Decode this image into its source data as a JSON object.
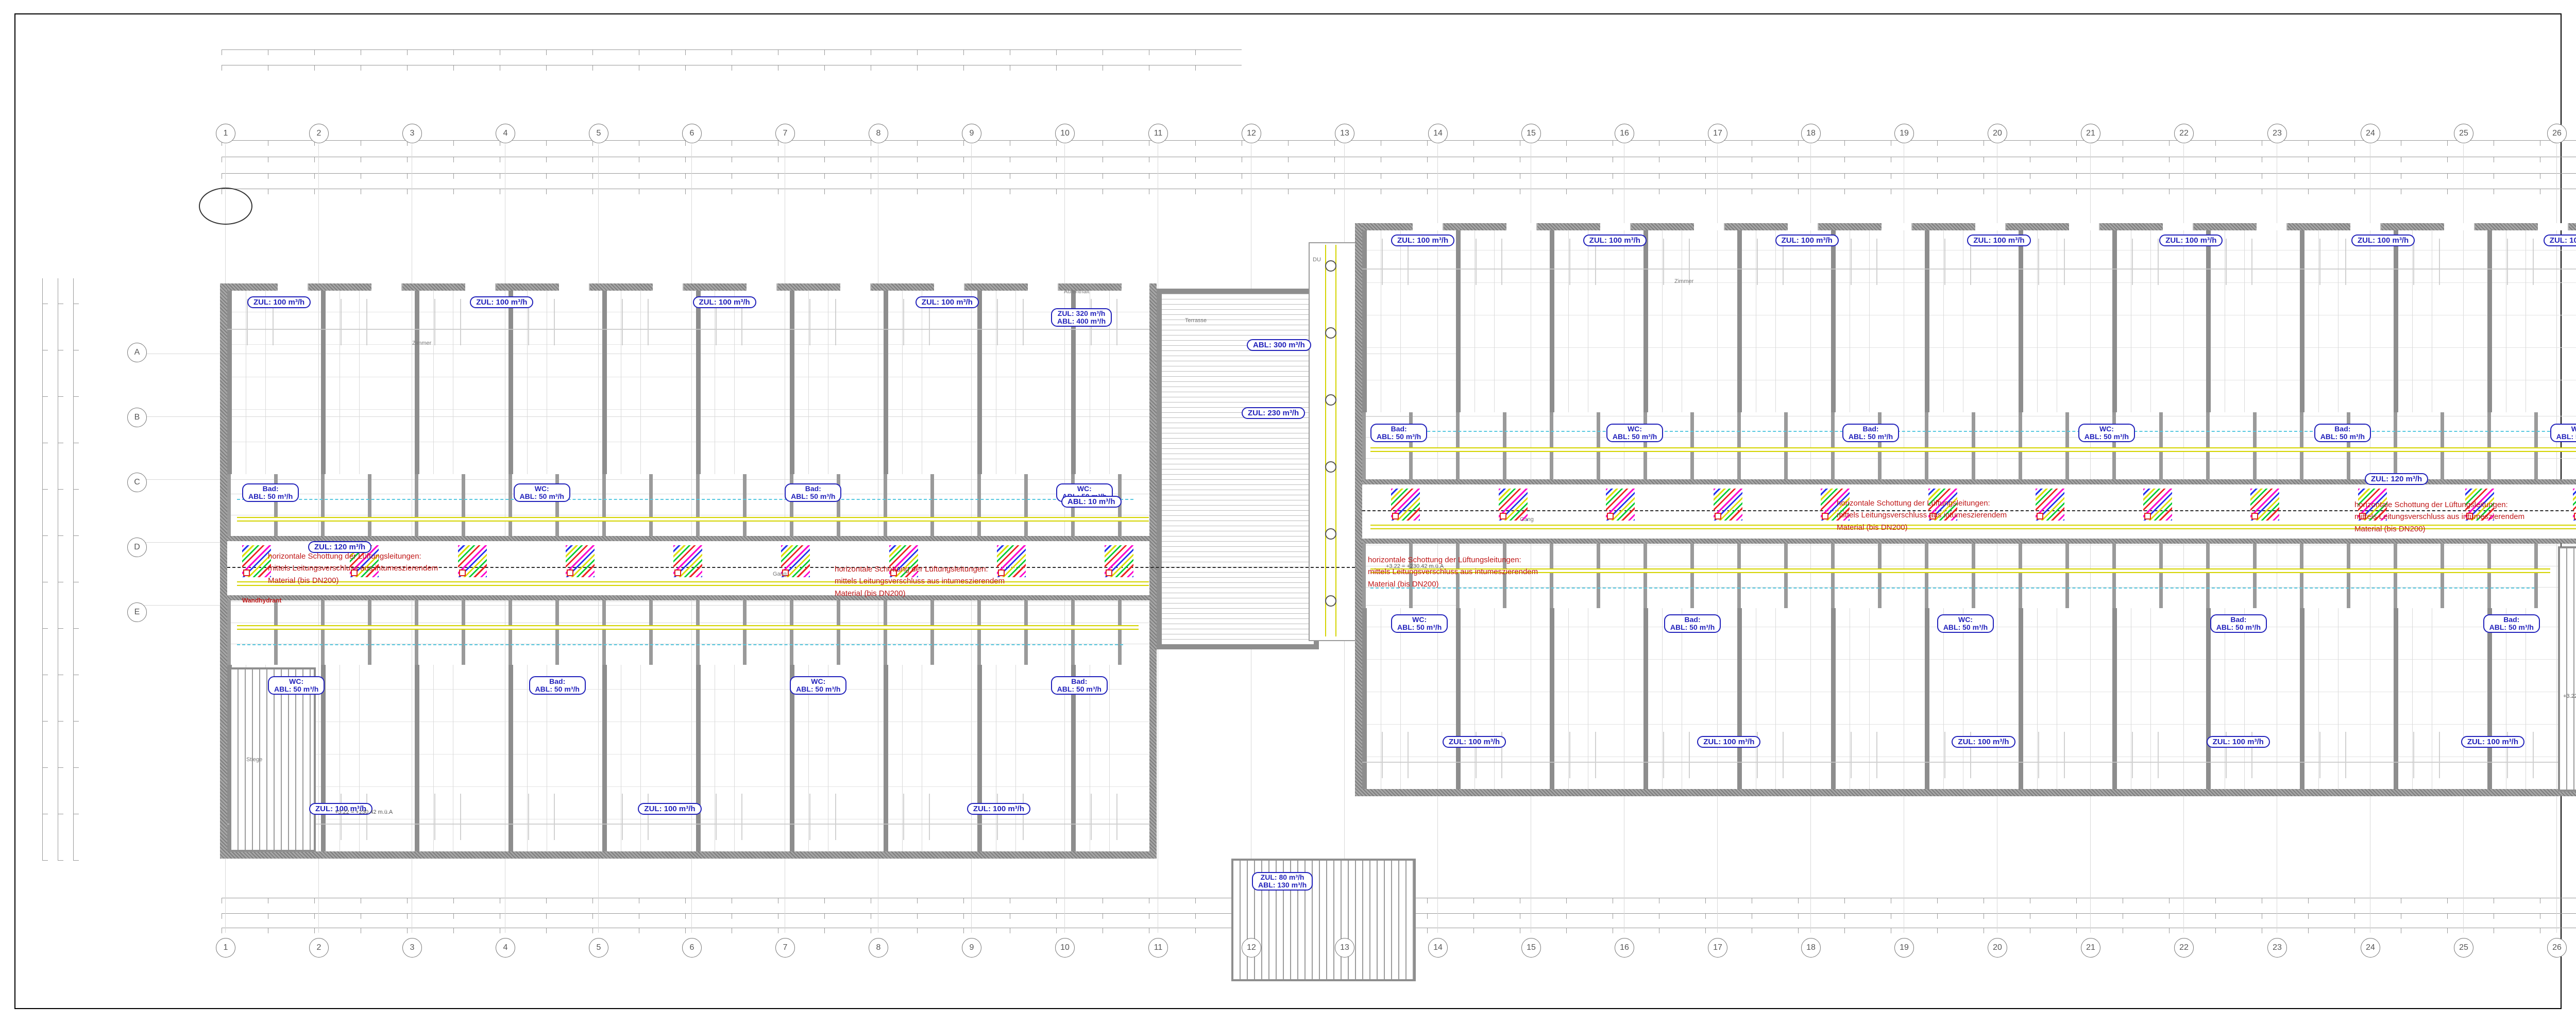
{
  "legend": {
    "title": "Legende Installationstechnik",
    "sections": [
      {
        "title": "HEIZUNGSVERSORGUNG",
        "col1": [
          {
            "c": "#000000",
            "l": "Heizung Symbol"
          },
          {
            "c": "#e6143c",
            "l": "Heizung Vorlauf"
          },
          {
            "c": "#1e1ee6",
            "l": "Heizung Rücklauf"
          },
          {
            "c": "#a05a5a",
            "l": "Fernwärme Vorlauf"
          },
          {
            "c": "#28327d",
            "l": "Fernwärme Rücklauf"
          }
        ],
        "col2": [
          {
            "c": "#e61414",
            "l": "Heizung Dampf"
          },
          {
            "c": "#82c882",
            "l": "Heizung Kondensat"
          },
          {
            "c": "#8c6450",
            "l": "Heizölleitung"
          },
          {
            "c": "#e61414",
            "l": "Begleitheizung"
          },
          {
            "c": "#000000",
            "l": "Heizung Text"
          }
        ]
      },
      {
        "title": "SANITÄRSVERSORGUNG",
        "col1": [
          {
            "c": "#000000",
            "l": "Sanitär Symbol"
          },
          {
            "c": "#64961e",
            "l": "Sanitär Kaltwasser"
          },
          {
            "c": "#96dcd2",
            "l": "Kaltwasser enthärtet"
          },
          {
            "c": "#ff9614",
            "l": "Warmwasser"
          },
          {
            "c": "#8c2828",
            "l": "Warmwasser enthärtet"
          },
          {
            "c": "#00c81e",
            "l": "Nutzwasser"
          },
          {
            "c": "#32b4e6",
            "l": "Regenwasser"
          },
          {
            "c": "#96321e",
            "l": "Schmutzwasser"
          },
          {
            "l": "Wasserzähler"
          }
        ],
        "col2": [
          {
            "c": "#6e7d5f",
            "l": "Grauwasser"
          },
          {
            "c": "#c8a87d",
            "l": "Sanitär Kondensat"
          },
          {
            "c": "#96289b",
            "l": "Zirkulation"
          },
          {
            "c": "#e61446",
            "l": "Löschleitung"
          },
          {
            "c": "#c3b913",
            "l": "Sanitär Gas"
          },
          {
            "c": "#c8c8c8",
            "l": "Sanitär Druckluft"
          },
          {
            "c": "#000000",
            "l": "Sanitär Text"
          }
        ]
      },
      {
        "title": "SONDERGASE",
        "col1": [
          {
            "c": "#000000",
            "l": "Sond.Gase Symbol"
          },
          {
            "c": "#14e6e6",
            "l": "Sond.Gase Druckluft"
          },
          {
            "c": "#b4aa14",
            "l": "Sond.Gase Erdgas"
          },
          {
            "c": "#e6a019",
            "l": "Argon"
          },
          {
            "c": "#a5f0f0",
            "l": "Helium HE-5.0"
          },
          {
            "c": "#1e28e6",
            "l": "Sauerstoff O2-4.5"
          },
          {
            "c": "#1e28e6",
            "l": "Sauerstoff O2-5.0"
          },
          {
            "c": "#1e28e6",
            "l": "Sauerstoff O2-Tec"
          }
        ],
        "col2": [
          {
            "c": "#00e632",
            "l": "Stickstoff N2-5.0"
          },
          {
            "c": "#00e632",
            "l": "Stickstoff N2-TEC"
          },
          {
            "c": "#00dc28",
            "l": "Stickstoff N2-TRO"
          },
          {
            "c": "#96e696",
            "l": "Synthetische Luft"
          },
          {
            "c": "#e61414",
            "l": "Wasserstoff H2-5.0"
          },
          {
            "c": "#e61414",
            "l": "Wasserstoff H2-TEC"
          },
          {
            "c": "#000000",
            "l": "Sond.Gase Text"
          }
        ]
      },
      {
        "title": "MSR",
        "col1": [
          {
            "c": "#000000",
            "l": "Symbol MSR"
          },
          {
            "c": "#000000",
            "l": "MSR Text"
          }
        ],
        "col2": []
      },
      {
        "title": "LÜFTUNG",
        "col1": [
          {
            "c": "#000000",
            "l": "Lüftung Symbol"
          },
          {
            "c": "#e614e6",
            "l": "Zuluft"
          },
          {
            "c": "#e6e614",
            "l": "Abluft"
          },
          {
            "c": "#00c814",
            "l": "Aussenluft"
          },
          {
            "c": "#ffff00",
            "l": "Fortluft"
          }
        ],
        "col2": [
          {
            "c": "#e6d2a0",
            "l": "Umluft"
          },
          {
            "c": "#000000",
            "l": "Auslässe"
          },
          {
            "c": "#e61414",
            "l": "Brandabschottung"
          },
          {
            "c": "#e61414",
            "l": "Brandschutzklappen"
          },
          {
            "c": "#000000",
            "l": "Lüftung Text"
          }
        ]
      },
      {
        "title": "KÄLTE",
        "col1": [
          {
            "c": "#000000",
            "l": "Kälte Symbol"
          },
          {
            "c": "#146432",
            "l": "Kälte Vorlauf"
          },
          {
            "c": "#50e650",
            "l": "Kälte Rücklauf"
          },
          {
            "c": "#5050c8",
            "l": "Rückkühler Vorlauf"
          },
          {
            "c": "#a0b4f0",
            "l": "Rückkühler Rücklauf"
          }
        ],
        "col2": [
          {
            "c": "#14e6e6",
            "l": "Kältemittel",
            "n": "(Freon Flüssiggas)"
          },
          {
            "c": "#e61464",
            "l": "Kältemittel",
            "n": "(Freon Heissgas)"
          },
          {
            "c": "#000000",
            "l": "Kälte Text"
          }
        ]
      },
      {
        "title": "ALLGEMEIN",
        "col1": [
          {
            "c": "#000000",
            "l": "Brandabschnittsbezeichnung"
          },
          {
            "c": "#e61414",
            "l": "Durchbrüche"
          },
          {
            "c": "#000000",
            "l": "Durchbrüche Text"
          }
        ],
        "col2": []
      },
      {
        "title": "HÖHENKOTEN",
        "col1": [
          {
            "a": "ZDUK",
            "l": "Zwischendeckenunterkante"
          },
          {
            "a": "RDUK",
            "l": "Rohdeckenunterkante"
          },
          {
            "a": "FBOK",
            "l": "Fußbodenoberkante"
          },
          {
            "a": "",
            "l": "±0,00 | =FBOK lt.Arch.plan"
          }
        ],
        "col2": [
          {
            "a": "KUK",
            "l": "Kanalunterkante"
          },
          {
            "a": "RM",
            "l": "Rohrmitte"
          },
          {
            "a": "KS",
            "l": "Kanalsohle"
          }
        ]
      }
    ],
    "bauteile": {
      "title": "BAUTEILE",
      "items": [
        {
          "s": "▤",
          "l": "Schalldämpfer"
        },
        {
          "s": "⊲",
          "l": "Volumenstromregler variabel"
        },
        {
          "s": "⊲",
          "l": "Volumenstromregler konstant"
        },
        {
          "s": "⊠",
          "l": "BSK Brandschutzklappe mit Motorantrieb",
          "cls": "red"
        },
        {
          "s": "⊠",
          "l": "Motorklappe"
        },
        {
          "s": "▨",
          "l": "Regelklappe, Drosselklappe"
        },
        {
          "s": "⊳",
          "l": "Rückschlagklappe"
        },
        {
          "s": "▨",
          "l": "Jalousieklappe"
        },
        {
          "s": "◉",
          "l": "Ventilator"
        },
        {
          "s": "▧",
          "l": "Filter"
        },
        {
          "s": "▯",
          "l": "Heiz-, Nachheizregister"
        },
        {
          "s": "▦",
          "l": "Kühl-, Nachkühlregister mit Tropftasse"
        },
        {
          "s": "FU",
          "l": "Frequenzumformer"
        },
        {
          "s": "◯",
          "l": "Pumpe"
        },
        {
          "s": "⋈",
          "l": "Absperrventil"
        },
        {
          "s": "⋈",
          "l": "Magnetventil"
        },
        {
          "s": "⊡",
          "l": "Absperrklappe"
        },
        {
          "s": "⋈",
          "l": "Kugelhahn"
        },
        {
          "s": "⋈",
          "l": "Regulierventil"
        },
        {
          "s": "⋈",
          "l": "Regulierventil mit Messnippel"
        },
        {
          "s": "⊿",
          "l": "Schmutzfänger"
        },
        {
          "s": "⊠",
          "l": "Rückschlagklappe, Ventil"
        },
        {
          "s": "≍",
          "l": "Kompensator"
        },
        {
          "s": "∿",
          "l": "Flexibler Schlauchanschluß"
        },
        {
          "s": "⋈",
          "l": "Mischventil mit Motorantrieb"
        },
        {
          "s": "⋈",
          "l": "Durchgangsventil mit Motorantrieb"
        },
        {
          "s": "⋈",
          "l": "Druck und Durchflußregler"
        },
        {
          "s": "○",
          "l": "Meßnippel"
        },
        {
          "s": "⊕",
          "l": "Temperaturanzeige"
        },
        {
          "s": "⊕",
          "l": "Druckanzeige"
        },
        {
          "s": "⊕",
          "l": "Stellantrieb mit Motor"
        },
        {
          "s": "⊕",
          "l": "Differenzdruckmeßstelle"
        },
        {
          "s": "▮",
          "l": "Maschinenthermometer"
        },
        {
          "s": "△",
          "l": "Sicherheitsventil mit Ablauftrichter"
        },
        {
          "s": "◐",
          "l": "Wärmemengenzähler"
        }
      ]
    },
    "sonstige": {
      "title": "SONSTIGE INFORMATIONEN",
      "room_box": [
        "01.000.001",
        "20 | 26",
        "2 kW | 300W"
      ],
      "room_labels": [
        "Raumnummer",
        "Raumtemperatur Winter [°C]",
        "Raumtemperatur Sommer [°C]",
        "Kühllast [W]",
        "Heizlast [W]"
      ],
      "luft_box": "L01  ZUL 1x100 m³/h",
      "luft_labels": [
        "Luftmenge",
        "Lüftungsart",
        "Lüftungsanlagennummer"
      ]
    }
  },
  "titleblock": {
    "montageplan": "MONTAGEPLAN",
    "firm_name": "REICHT HAUSTECHNIK",
    "firm_address": [
      "8380 Jennersdorf, Hauptstraße 61",
      "03329/45394 - fax dw 20",
      "www.reicht-haustechnik.at",
      "office@reicht-haustechnik.at"
    ],
    "bauherr_label": "BAUHERR:",
    "bauherr": [
      "Militärisches Immobilienmanagement Zentrum",
      "Roßauer Lände 1",
      "A-1090 Wien"
    ],
    "planverfasser_label": "PLANVERFASSER:",
    "planverfasser": [
      "Reicht Haustechnik GmbH",
      "Hauptstraße 61",
      "A-8380 Jennersdorf"
    ],
    "projekt_label": "PROJEKT:",
    "projekt": "VON DER GRÖBEN KASERENE FB",
    "planinhalt_label": "PLANINHALT:",
    "planinhalt": "Montageplanung OG1",
    "rev_rows": [
      "3",
      "2",
      "1"
    ],
    "rev_header": {
      "gez": "Gez.",
      "aend": "Änderung und Ergänzung",
      "tag": "Tag",
      "name": "Name",
      "gepr": "Gepr."
    },
    "meta": {
      "datum_h": "Datum",
      "name_h": "Name",
      "rows": [
        {
          "k": "Gez",
          "d": "11.06.2021",
          "n": "DS"
        },
        {
          "k": "Gepr.",
          "d": "11.06.2021",
          "n": "DS"
        },
        {
          "k": "Norm gepr.",
          "d": "—",
          "n": ""
        }
      ],
      "massstab_label": "Maßstab",
      "massstab": "1:50",
      "plangroesse_label": "Plangröße",
      "plangroesse": "— — —",
      "znr_label": "Zeichnung Nr.:",
      "znr": "OG1_GR_20210611_01",
      "zdatei_label": "Zeichnung Datei:",
      "zdatei": "OG1.n7p",
      "raster_label": "Raster Datei:",
      "ersatz_label": "Ersatz für:",
      "ersetzt_label": "Ersetzt durch:",
      "disclaimer": "Die Weitergabe, Vervielfältigung, Verwertung dieser Unterlage und die Mitteilung ihres Inhaltes sind nicht gestattet, soweit nicht ausdrücklich zugestanden. Zuwiderhandlungen verpflichten zu Schadenersatz. Alle Rechte vorbehalten. Dieser Plan ist laufend mit den letztgültigen Polier-, E- und Einrichtungsplänen zu prüfen und abzustimmen."
    }
  },
  "plan": {
    "axes_numbers": [
      "1",
      "2",
      "3",
      "4",
      "5",
      "6",
      "7",
      "8",
      "9",
      "10",
      "11",
      "12",
      "13",
      "14",
      "15",
      "16",
      "17",
      "18",
      "19",
      "20",
      "21",
      "22",
      "23",
      "24",
      "25",
      "26",
      "27"
    ],
    "axes_letters": [
      "A",
      "B",
      "C",
      "D",
      "E"
    ],
    "labels": {
      "zul100": "ZUL: 100 m³/h",
      "zul120": "ZUL: 120 m³/h",
      "abl300": "ABL: 300 m³/h",
      "zul230": "ZUL: 230 m³/h",
      "abl10": "ABL: 10 m³/h",
      "zul320": {
        "a": "ZUL: 320 m³/h",
        "b": "ABL: 400 m³/h"
      },
      "stair2": {
        "a": "ZUL: 80 m³/h",
        "b": "ABL: 130 m³/h"
      }
    },
    "rows": {
      "right_top": [
        "ZUL: 100 m³/h",
        "ZUL: 100 m³/h",
        "ZUL: 100 m³/h",
        "ZUL: 100 m³/h",
        "ZUL: 100 m³/h",
        "ZUL: 100 m³/h",
        "ZUL: 100 m³/h"
      ],
      "left_top": [
        "ZUL: 100 m³/h",
        "ZUL: 100 m³/h",
        "ZUL: 100 m³/h",
        "ZUL: 100 m³/h"
      ],
      "right_bottom": [
        "ZUL: 100 m³/h",
        "ZUL: 100 m³/h",
        "ZUL: 100 m³/h",
        "ZUL: 100 m³/h",
        "ZUL: 100 m³/h"
      ],
      "left_bottom": [
        "ZUL: 100 m³/h",
        "ZUL: 100 m³/h",
        "ZUL: 100 m³/h"
      ],
      "right_upper_serv": [
        {
          "a": "Bad:",
          "b": "ABL: 50 m³/h"
        },
        {
          "a": "WC:",
          "b": "ABL: 50 m³/h"
        },
        {
          "a": "Bad:",
          "b": "ABL: 50 m³/h"
        },
        {
          "a": "WC:",
          "b": "ABL: 50 m³/h"
        },
        {
          "a": "Bad:",
          "b": "ABL: 50 m³/h"
        },
        {
          "a": "WC:",
          "b": "ABL: 50 m³/h"
        }
      ],
      "left_upper_serv": [
        {
          "a": "Bad:",
          "b": "ABL: 50 m³/h"
        },
        {
          "a": "WC:",
          "b": "ABL: 50 m³/h"
        },
        {
          "a": "Bad:",
          "b": "ABL: 50 m³/h"
        },
        {
          "a": "WC:",
          "b": "ABL: 50 m³/h"
        }
      ],
      "right_lower_serv": [
        {
          "a": "WC:",
          "b": "ABL: 50 m³/h"
        },
        {
          "a": "Bad:",
          "b": "ABL: 50 m³/h"
        },
        {
          "a": "WC:",
          "b": "ABL: 50 m³/h"
        },
        {
          "a": "Bad:",
          "b": "ABL: 50 m³/h"
        },
        {
          "a": "Bad:",
          "b": "ABL: 50 m³/h"
        }
      ],
      "left_lower_serv": [
        {
          "a": "WC:",
          "b": "ABL: 50 m³/h"
        },
        {
          "a": "Bad:",
          "b": "ABL: 50 m³/h"
        },
        {
          "a": "WC:",
          "b": "ABL: 50 m³/h"
        },
        {
          "a": "Bad:",
          "b": "ABL: 50 m³/h"
        }
      ]
    },
    "red_note": [
      "horizontale Schottung der Lüftungsleitungen:",
      "mittels Leitungsverschluss aus intumeszierendem",
      "Material (bis DN200)"
    ],
    "wandhydrant": "Wandhydrant",
    "elevation": "+3.22 = +230.42 m.ü.A",
    "rooms": {
      "zimmer": "Zimmer",
      "bad": "Bad",
      "vr": "VR",
      "wc": "WC",
      "gang": "Gang",
      "stiege": "Stiege",
      "terrasse": "Terrasse",
      "aufenthalt": "Aufenthalt",
      "du": "DU"
    },
    "compass": {
      "n": "N",
      "s": "S",
      "nw": "NW",
      "no": "NO",
      "sw": "SW",
      "so": "SO"
    }
  }
}
